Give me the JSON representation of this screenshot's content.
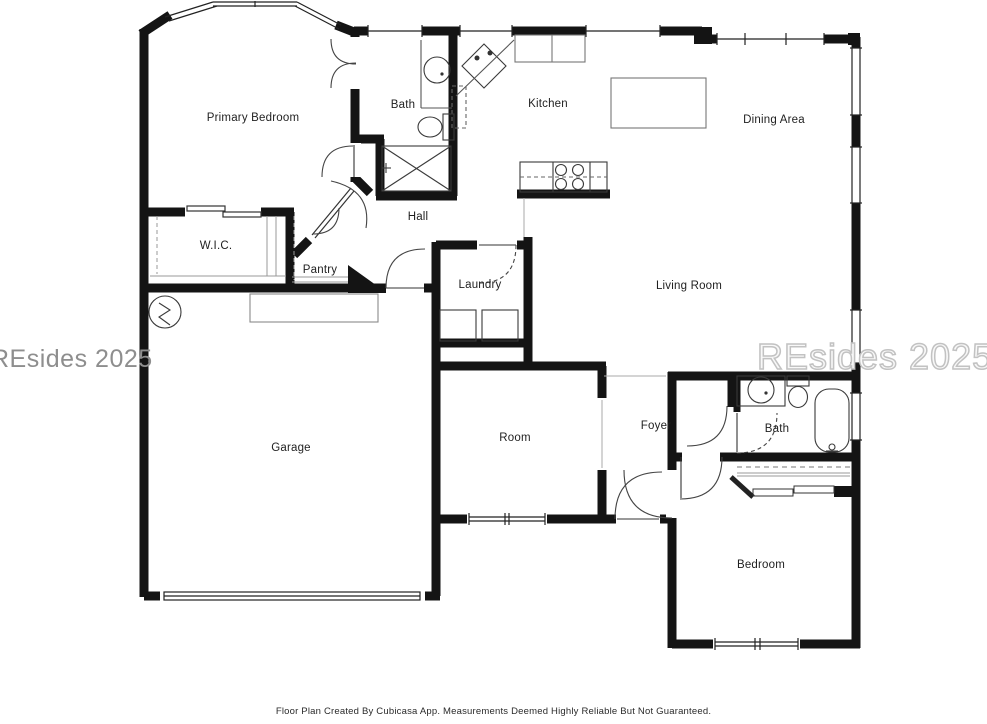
{
  "watermarks": {
    "left": "REsides 2025",
    "right": "REsides 2025"
  },
  "footer": {
    "disclaimer": "Floor Plan Created By Cubicasa App. Measurements Deemed Highly Reliable But Not Guaranteed."
  },
  "rooms": [
    {
      "id": "primary-bedroom",
      "label": "Primary Bedroom"
    },
    {
      "id": "bath-primary",
      "label": "Bath"
    },
    {
      "id": "kitchen",
      "label": "Kitchen"
    },
    {
      "id": "dining-area",
      "label": "Dining Area"
    },
    {
      "id": "hall",
      "label": "Hall"
    },
    {
      "id": "wic",
      "label": "W.I.C."
    },
    {
      "id": "pantry",
      "label": "Pantry"
    },
    {
      "id": "laundry",
      "label": "Laundry"
    },
    {
      "id": "living-room",
      "label": "Living Room"
    },
    {
      "id": "garage",
      "label": "Garage"
    },
    {
      "id": "room",
      "label": "Room"
    },
    {
      "id": "foyer",
      "label": "Foyer"
    },
    {
      "id": "bath-2",
      "label": "Bath"
    },
    {
      "id": "bedroom",
      "label": "Bedroom"
    }
  ],
  "colors": {
    "wall": "#141414",
    "thin_line": "#3a3a3a",
    "opening_line": "#aaaaaa",
    "watermark_left": "#8e8e8e",
    "watermark_right_outline": "#c2c2c2"
  }
}
